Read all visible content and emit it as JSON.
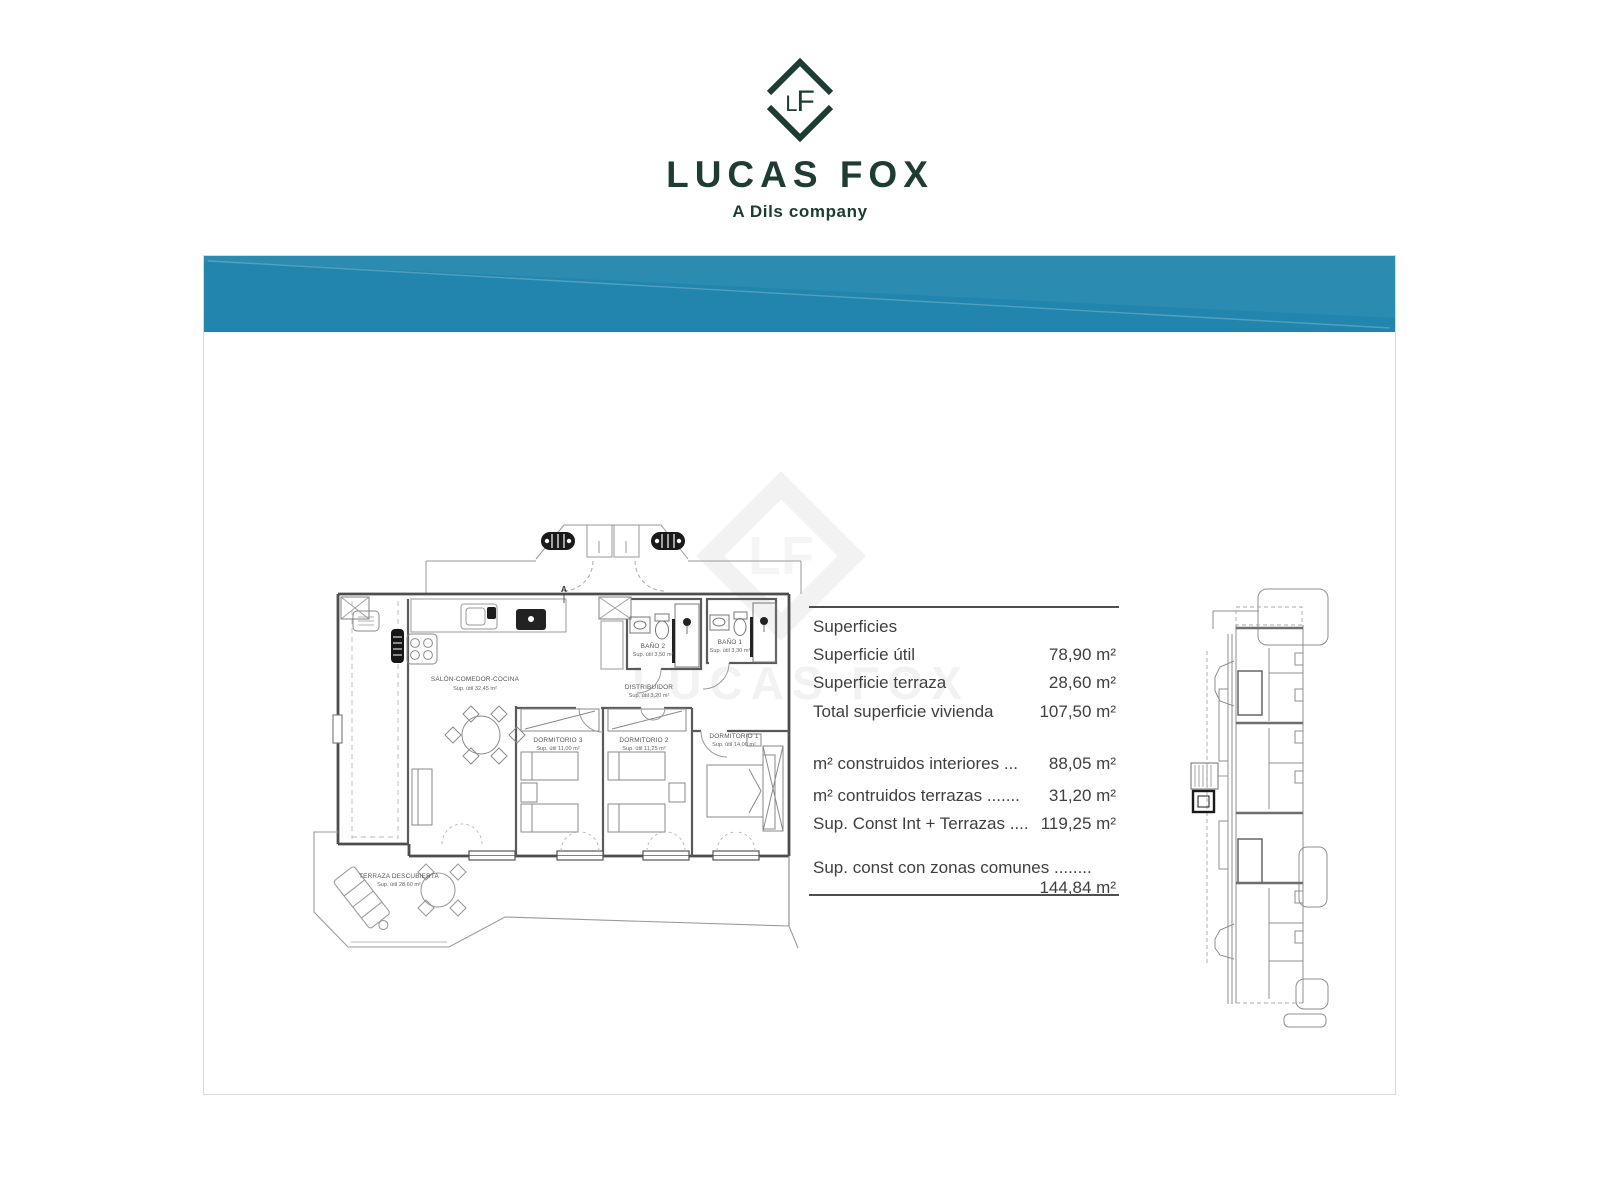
{
  "brand": {
    "monogram": "LF",
    "name": "LUCAS FOX",
    "tagline": "A Dils company",
    "colors": {
      "dark_green": "#1d3c33",
      "banner_teal": "#2185ad"
    }
  },
  "superficies_table": {
    "title": "Superficies",
    "rows_group1": [
      {
        "label": "Superficie útil",
        "value": "78,90 m²"
      },
      {
        "label": "Superficie terraza",
        "value": "28,60 m²"
      },
      {
        "label": "Total superficie vivienda",
        "value": "107,50 m²"
      }
    ],
    "rows_group2": [
      {
        "label": "m² construidos interiores ...",
        "value": "88,05 m²"
      },
      {
        "label": "m² contruidos terrazas .......",
        "value": "31,20 m²"
      },
      {
        "label": "Sup. Const Int + Terrazas ....",
        "value": "119,25 m²"
      }
    ],
    "rows_group3": [
      {
        "label": "Sup. const con zonas comunes ........",
        "value": "144,84 m²"
      }
    ]
  },
  "floor_plan": {
    "section_marker": "A",
    "rooms": [
      {
        "name": "SALÓN-COMEDOR-COCINA",
        "area": "Sup. útil 32,45 m²"
      },
      {
        "name": "DISTRIBUIDOR",
        "area": "Sup. útil 3,20 m²"
      },
      {
        "name": "BAÑO 2",
        "area": "Sup. útil 3,50 m²"
      },
      {
        "name": "BAÑO 1",
        "area": "Sup. útil 3,30 m²"
      },
      {
        "name": "DORMITORIO 3",
        "area": "Sup. útil 11,00 m²"
      },
      {
        "name": "DORMITORIO 2",
        "area": "Sup. útil 11,25 m²"
      },
      {
        "name": "DORMITORIO 1",
        "area": "Sup. útil 14,00 m²"
      },
      {
        "name": "TERRAZA DESCUBIERTA",
        "area": "Sup. útil 28,60 m²"
      }
    ]
  }
}
